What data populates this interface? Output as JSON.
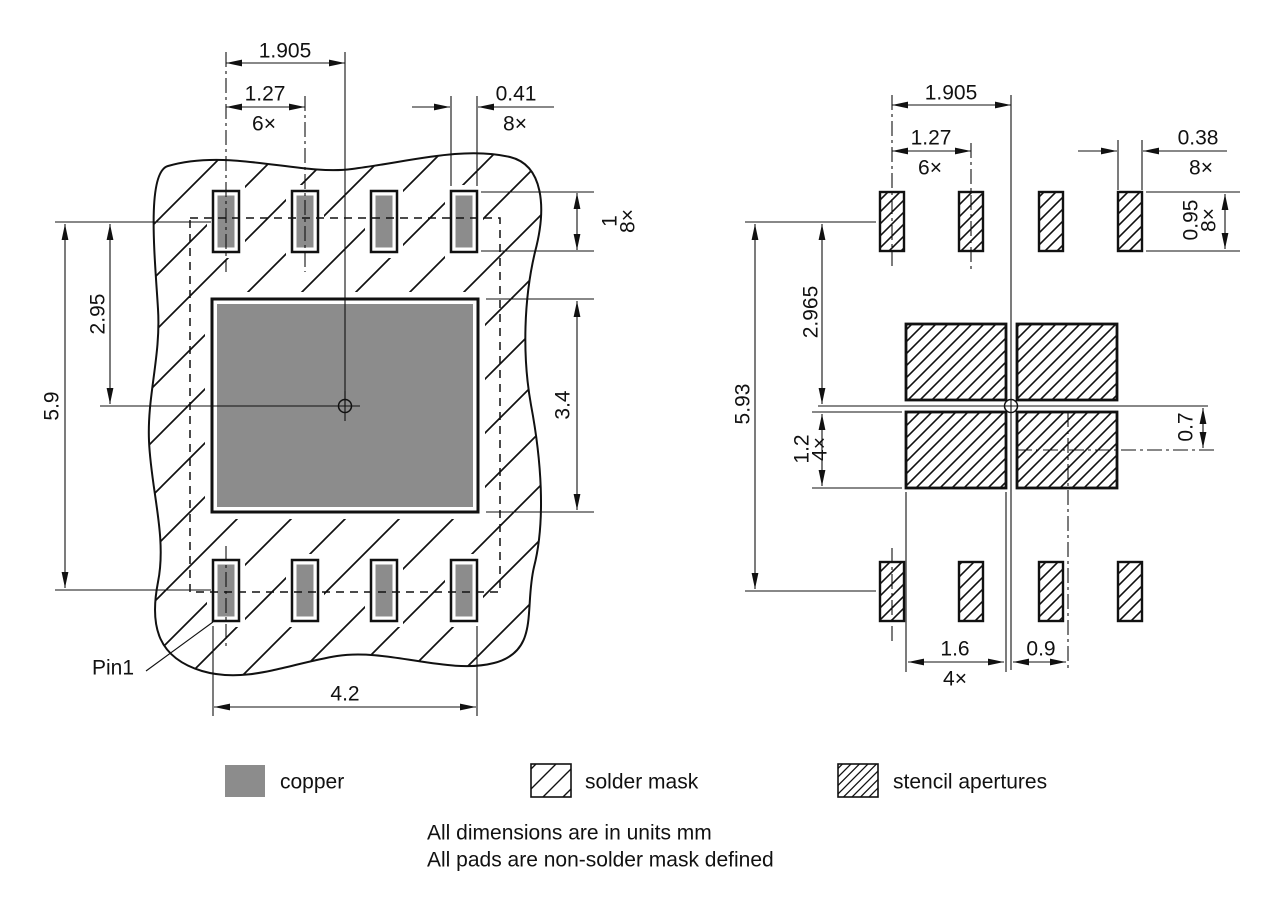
{
  "drawing": {
    "left_view": {
      "pitch_span": "1.905",
      "pitch": "1.27",
      "pitch_qty": "6×",
      "pad_width": "0.41",
      "pad_width_qty": "8×",
      "pad_height": "1",
      "pad_height_qty": "8×",
      "row_offset": "2.95",
      "row_span": "5.9",
      "thermal_height": "3.4",
      "outer_span": "4.2",
      "pin1_label": "Pin1"
    },
    "right_view": {
      "pitch_span": "1.905",
      "pitch": "1.27",
      "pitch_qty": "6×",
      "aperture_width": "0.38",
      "aperture_width_qty": "8×",
      "aperture_height": "0.95",
      "aperture_height_qty": "8×",
      "row_offset": "2.965",
      "row_span": "5.93",
      "thermal_aperture_height": "1.2",
      "thermal_aperture_height_qty": "4×",
      "thermal_offset_y": "0.7",
      "thermal_aperture_width": "1.6",
      "thermal_aperture_width_qty": "4×",
      "thermal_offset_x": "0.9"
    }
  },
  "legend": {
    "copper": "copper",
    "solder_mask": "solder mask",
    "stencil": "stencil apertures"
  },
  "notes": {
    "line1": "All dimensions are in units mm",
    "line2": "All pads are non-solder mask defined"
  },
  "colors": {
    "copper": "#8c8c8c",
    "line": "#111111",
    "background": "#ffffff"
  }
}
